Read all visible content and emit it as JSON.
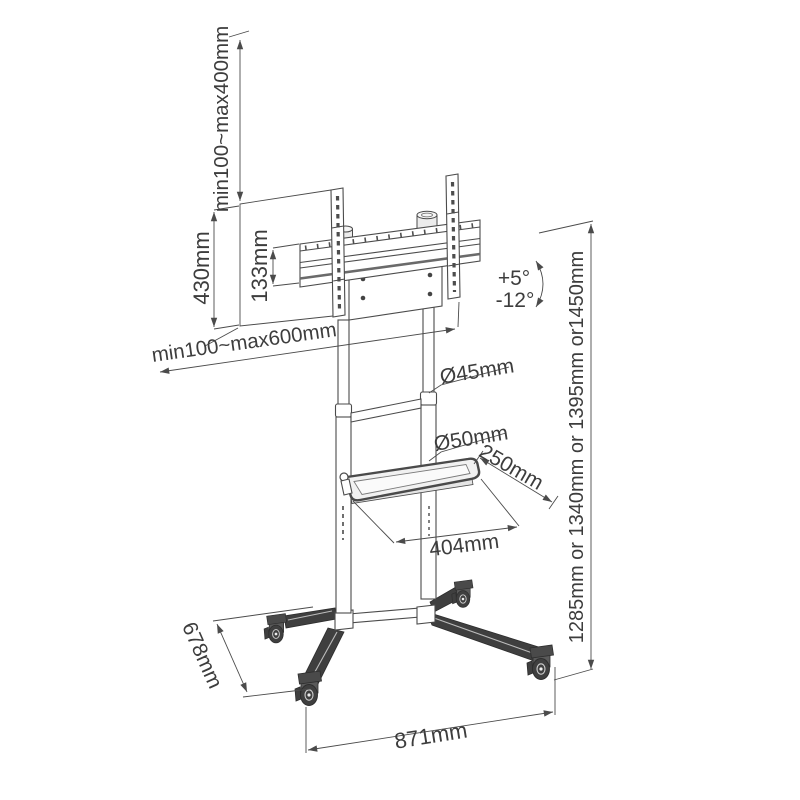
{
  "diagram": {
    "type": "technical-dimension-drawing",
    "subject": "mobile TV floor stand trolley with tilting VESA bracket, middle shelf and four casters",
    "colors": {
      "background": "#ffffff",
      "line": "#4b4b4b",
      "text": "#3d3d3d",
      "dark_fill": "#3f3f3f"
    }
  },
  "labels": {
    "vesa_height_range": "min100~max400mm",
    "bracket_height": "430mm",
    "crossbar_height": "133mm",
    "vesa_width_range": "min100~max600mm",
    "tilt_up": "+5°",
    "tilt_down": "-12°",
    "upper_column_diameter": "Ø45mm",
    "lower_column_diameter": "Ø50mm",
    "shelf_depth": "250mm",
    "shelf_width": "404mm",
    "height_options": "1285mm or 1340mm or 1395mm or1450mm",
    "base_depth": "678mm",
    "base_width": "871mm"
  }
}
